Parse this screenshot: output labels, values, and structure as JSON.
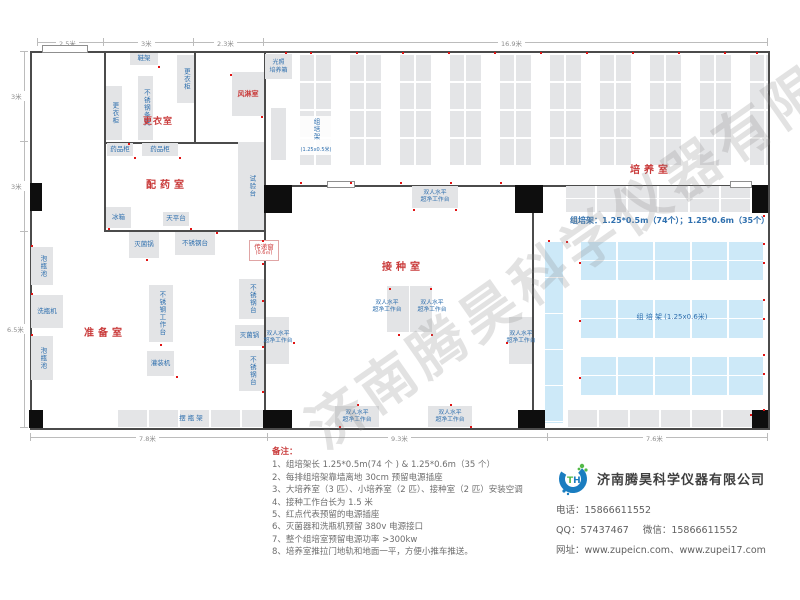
{
  "watermark": "济南腾昊科学仪器有限公司",
  "dimensions": {
    "top": [
      "2.5米",
      "3米",
      "2.3米",
      "16.9米"
    ],
    "left": [
      "3米",
      "3米",
      "6.5米"
    ],
    "bottom": [
      "7.8米",
      "9.3米",
      "7.6米"
    ]
  },
  "rooms": {
    "dressing": {
      "name": "更衣室",
      "shoe_rack": "鞋架",
      "locker": "更衣柜",
      "bench": "不锈钢条凳"
    },
    "air_shower": {
      "name": "风淋室"
    },
    "pharmacy": {
      "name": "配药室",
      "cabinet": "药品柜",
      "fridge": "冰箱",
      "balance": "天平台",
      "test_bench": "试验台"
    },
    "prep": {
      "name": "准备室",
      "soak_pool": "泡瓶池",
      "washer": "洗瓶机",
      "sterilizer": "灭菌锅",
      "ss_table": "不锈钢台",
      "ss_workbench": "不锈钢工作台",
      "filler": "灌装机",
      "bottle_rack": "摆 瓶 架"
    },
    "inoculation": {
      "name": "接种室",
      "bench_line1": "双人水平",
      "bench_line2": "超净工作台"
    },
    "culture": {
      "name": "培养室",
      "incubator_line1": "光照",
      "incubator_line2": "培养箱",
      "rack_v_label": "组培架",
      "rack_v_size": "(1.25x0.5米)",
      "spec": "组培架：1.25*0.5m（74个）；1.25*0.6m（35个）",
      "rack_h_label": "组 培 架 (1.25x0.6米)"
    }
  },
  "pass_window": {
    "name": "传递窗",
    "size": "(0.6㎡)"
  },
  "notes": {
    "title": "备注：",
    "items": [
      "1、组培架长 1.25*0.5m(74 个 ) & 1.25*0.6m（35 个）",
      "2、每排组培架靠墙离地 30cm 预留电源插座",
      "3、大培养室（3 匹）、小培养室（2 匹）、接种室（2 匹）安装空调",
      "4、接种工作台长为 1.5 米",
      "5、红点代表预留的电源插座",
      "6、灭菌器和洗瓶机预留 380v 电源接口",
      "7、整个组培室预留电源功率 >300kw",
      "8、培养室推拉门地轨和地面一平，方便小推车推送。"
    ]
  },
  "company": {
    "name": "济南腾昊科学仪器有限公司",
    "logo_text": "TH",
    "phone": "电话：15866611552",
    "qq": "QQ：57437467",
    "wechat": "微信：15866611552",
    "website": "网址：www.zupeicn.com、www.zupei17.com"
  },
  "colors": {
    "room_label": "#c93a3a",
    "equipment_text": "#2e6fae",
    "rack_blue": "#cde9f8",
    "rack_gray": "#e4e5e7",
    "outlet_dot": "#e01414"
  }
}
